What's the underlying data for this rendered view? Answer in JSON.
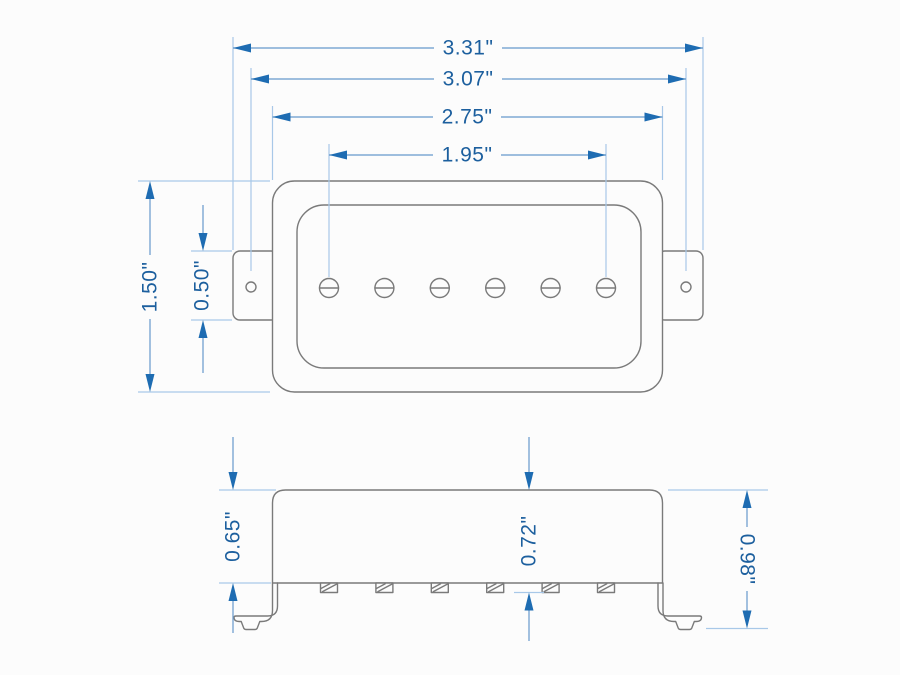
{
  "meta": {
    "units": "inches",
    "colors": {
      "background": "#fcfcfc",
      "outline": "#7a7a7a",
      "dimension_line": "#6699cc",
      "extension_line": "#a8c8e8",
      "arrow": "#1e6cb2",
      "dimension_text": "#1c5f9e"
    }
  },
  "top_view": {
    "pole_pieces": {
      "count": 6
    },
    "mounting_ears": {
      "count": 2,
      "screw_holes": 2
    },
    "dims": {
      "overall_width": {
        "label": "3.31\""
      },
      "mount_hole_spacing": {
        "label": "3.07\""
      },
      "body_width": {
        "label": "2.75\""
      },
      "pole_spread": {
        "label": "1.95\""
      },
      "body_height": {
        "label": "1.50\""
      },
      "ear_height": {
        "label": "0.50\""
      }
    }
  },
  "side_view": {
    "pole_screws": {
      "count": 6
    },
    "mounting_legs": {
      "count": 2
    },
    "dims": {
      "cover_height": {
        "label": "0.65\""
      },
      "depth_with_poles": {
        "label": "0.72\""
      },
      "overall_height": {
        "label": "0.98\""
      }
    }
  }
}
